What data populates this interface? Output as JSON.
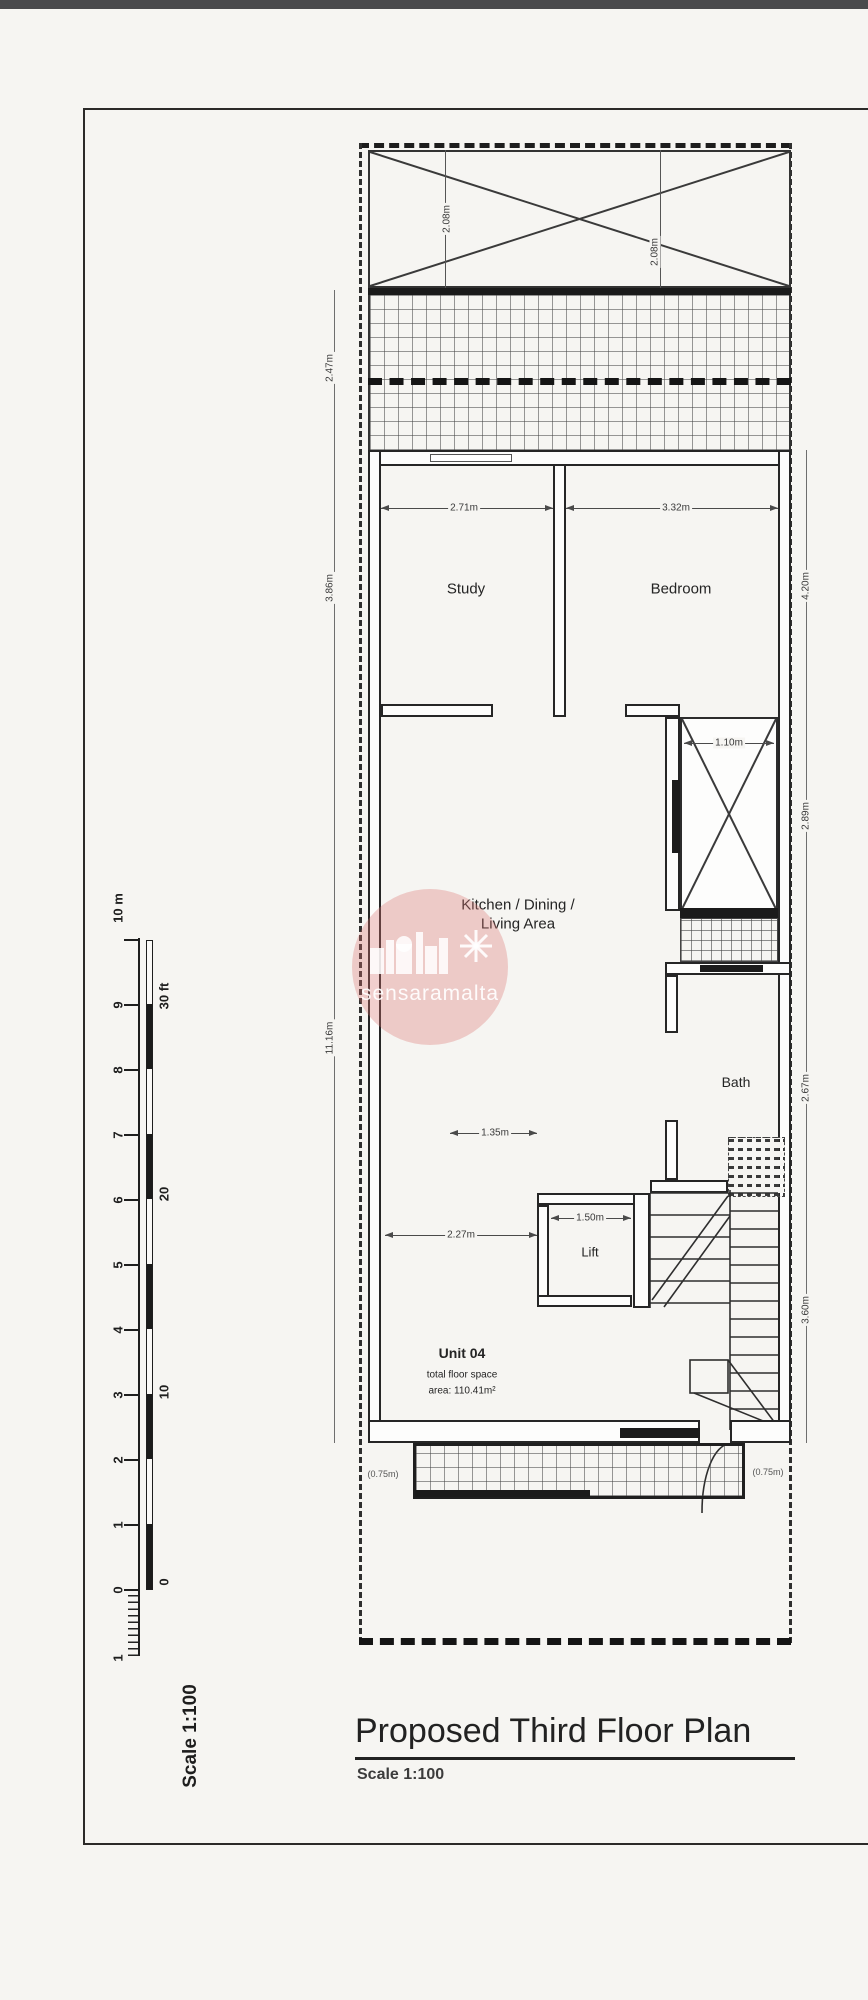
{
  "titleblock": {
    "title": "Proposed Third Floor Plan",
    "subtitle": "Scale 1:100"
  },
  "scalebar": {
    "meters_label": "10 m",
    "meter_ticks": [
      "9",
      "8",
      "7",
      "6",
      "5",
      "4",
      "3",
      "2",
      "1",
      "0",
      "1"
    ],
    "feet_labels": [
      "30 ft",
      "20",
      "10",
      "0"
    ],
    "rotated_label": "Scale 1:100"
  },
  "rooms": {
    "study": {
      "label": "Study",
      "width": "2.71m"
    },
    "bedroom": {
      "label": "Bedroom",
      "width": "3.32m"
    },
    "kitchen": {
      "line1": "Kitchen / Dining /",
      "line2": "Living Area"
    },
    "bath": {
      "label": "Bath"
    },
    "lift": {
      "label": "Lift",
      "width": "1.50m"
    },
    "shaft": {
      "width": "1.10m"
    }
  },
  "unit": {
    "name": "Unit 04",
    "floor_space_label": "total floor space",
    "area": "area: 110.41m²"
  },
  "dims": {
    "corridor": "1.35m",
    "kitchen_width": "2.27m",
    "left_terrace": "2.47m",
    "left_study": "3.86m",
    "left_kitchen": "11.16m",
    "right_bedroom_zone": "4.20m",
    "right_shaft_zone": "2.89m",
    "right_bath_zone": "2.67m",
    "right_stairs_zone": "3.60m",
    "roof_left": "2.08m",
    "roof_right": "2.08m",
    "balcony_left": "(0.75m)",
    "balcony_right": "(0.75m)"
  },
  "watermark": {
    "text": "sensaramalta"
  }
}
